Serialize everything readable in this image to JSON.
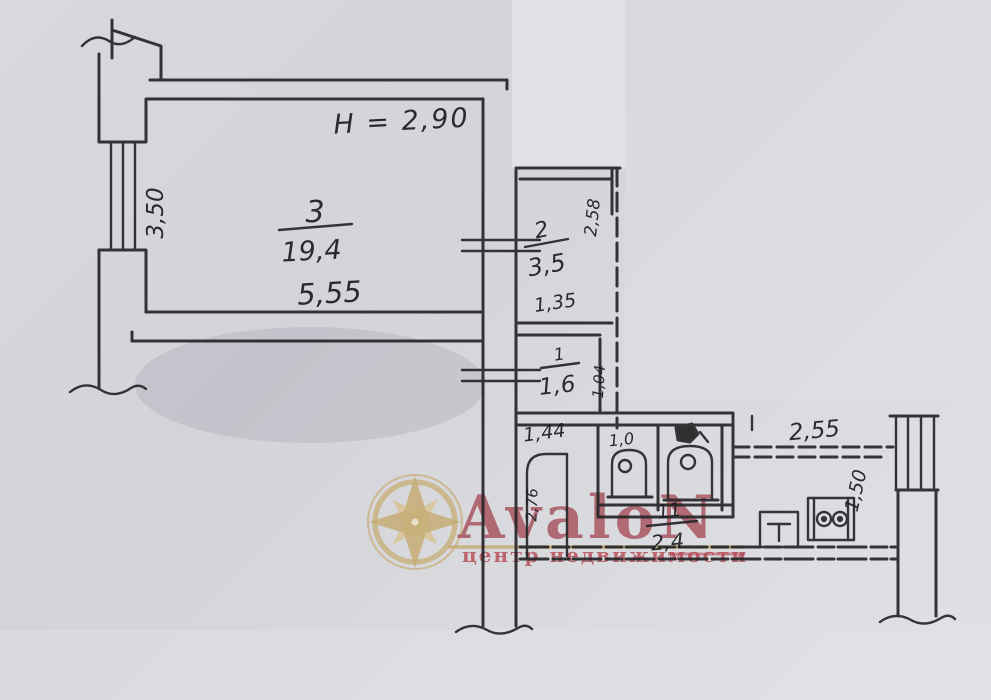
{
  "plan": {
    "ceiling_height_note": "H = 2,90",
    "rooms": [
      {
        "id": "living-room",
        "number": "3",
        "area": "19,4",
        "width_label": "5,55",
        "depth_label": "3,50"
      },
      {
        "id": "closet",
        "number": "2",
        "area": "3,5",
        "width_label": "1,35",
        "depth_label": "2,58"
      },
      {
        "id": "vestibule",
        "number": "1",
        "area": "1,6",
        "width_label": "1,44",
        "depth_label": "1,04"
      },
      {
        "id": "entry-hall",
        "depth_label": "2,76"
      },
      {
        "id": "wc",
        "width_label": "1,0"
      },
      {
        "id": "corridor",
        "number": "11",
        "area": "2,4"
      },
      {
        "id": "kitchen",
        "width_label": "2,55",
        "depth_label": "1,50"
      }
    ],
    "fixtures": [
      "toilet",
      "toilet",
      "sink",
      "stove"
    ]
  },
  "watermark": {
    "brand": "AvaloN",
    "tagline": "центр недвижимости",
    "brand_color": "#a03b46",
    "tagline_color": "#b4454f",
    "gold_color": "#c7ad74"
  }
}
